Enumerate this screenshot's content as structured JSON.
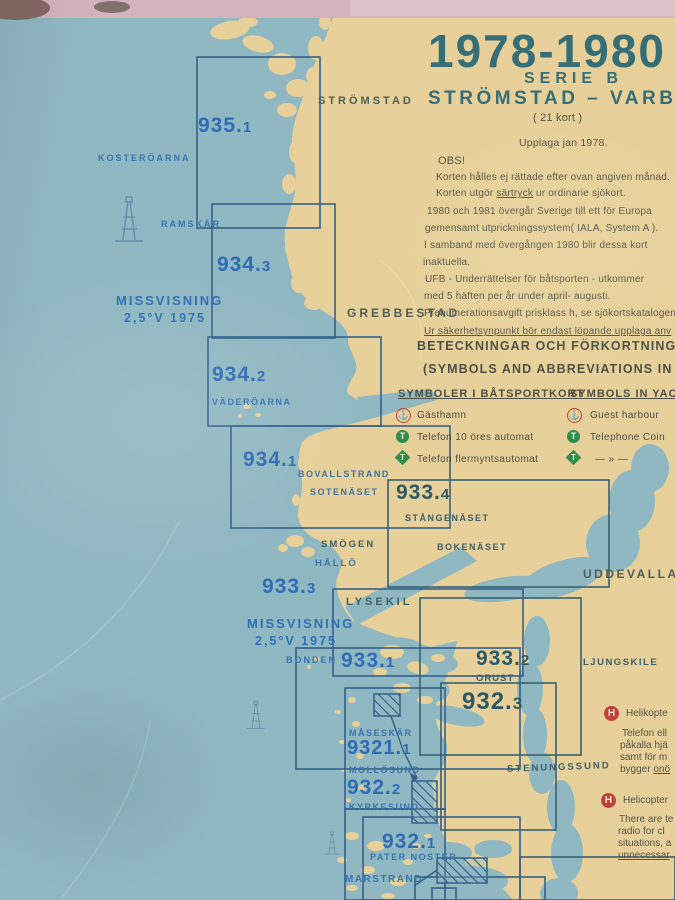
{
  "title": {
    "years": "1978-1980",
    "serie": "SERIE B",
    "route": "STRÖMSTAD – VARBER",
    "kort": "( 21 kort )",
    "upplaga": "Upplaga  jan  1978."
  },
  "notes": {
    "obs": "OBS!",
    "line1": "Korten hålles ej rättade efter ovan angiven månad.",
    "sartryck_pre": "Korten utgör ",
    "sartryck_word": "särtryck",
    "sartryck_post": " ur ordinarie sjökort.",
    "p2_l1": "1980 och 1981 övergår Sverige till ett för Europa",
    "p2_l2": "gemensamt utprickningssystem( IALA, System A ).",
    "p2_l3": "I samband med övergången 1980 blir dessa kort",
    "p2_l4": "inaktuella.",
    "ufb_l1": "UFB - Underrättelser för båtsporten - utkommer",
    "ufb_l2": "med 5 häften per år under april- augusti.",
    "ufb_l3": "Prenumerationsavgift prisklass h, se sjökortskatalogen.",
    "safety": "Ur säkerhetsynpunkt bör endast löpande upplaga anv",
    "beteckningar": "BETECKNINGAR OCH FÖRKORTNINGAR I KO",
    "symbols_en": "(SYMBOLS AND ABBREVIATIONS IN CHA"
  },
  "legend": {
    "header_sv": "SYMBOLER I BÅTSPORTKORT",
    "header_en": "SYMBOLS IN YAC",
    "row1_sv": "Gästhamn",
    "row1_en": "Guest harbour",
    "row2_sv": "Telefon 10 öres automat",
    "row2_en": "Telephone Coin",
    "row3_sv": "Telefon flermyntsautomat",
    "row3_en": "—  »  —"
  },
  "icons": {
    "anchor": "⚓",
    "phone_letter": "T",
    "heli_letter": "H"
  },
  "heli_sv": {
    "heading": "Helikopte",
    "l1": "Telefon ell",
    "l2": "påkalla hjä",
    "l3": "samt för m",
    "l4_pre": "bygger ",
    "l4_u": "onö"
  },
  "heli_en": {
    "heading": "Helicopter",
    "l1": "There are te",
    "l2": "radio for cl",
    "l3": "situations, a",
    "l4": "unnecessar"
  },
  "missvisning": {
    "l1": "MISSVISNING",
    "l2": "2,5°V  1975"
  },
  "charts": {
    "c935_1": {
      "main": "935.",
      "suffix": "1"
    },
    "c934_3": {
      "main": "934.",
      "suffix": "3"
    },
    "c934_2": {
      "main": "934.",
      "suffix": "2"
    },
    "c934_1": {
      "main": "934.",
      "suffix": "1"
    },
    "c933_4": {
      "main": "933.",
      "suffix": "4"
    },
    "c933_3": {
      "main": "933.",
      "suffix": "3"
    },
    "c933_1": {
      "main": "933.",
      "suffix": "1"
    },
    "c933_2": {
      "main": "933.",
      "suffix": "2"
    },
    "c932_3": {
      "main": "932.",
      "suffix": "3"
    },
    "c9321_1": {
      "main": "9321.",
      "suffix": "1"
    },
    "c932_2": {
      "main": "932.",
      "suffix": "2"
    },
    "c932_1": {
      "main": "932.",
      "suffix": "1"
    }
  },
  "places": {
    "stromstad": "STRÖMSTAD",
    "kosteroarna": "KOSTERÖARNA",
    "ramskar": "RAMSKÄR",
    "grebbestad": "GREBBESTAD",
    "vaderoarna": "VÄDERÖARNA",
    "bovallstrand": "BOVALLSTRAND",
    "sotenaset": "SOTENÄSET",
    "stangenaset": "STÅNGENÄSET",
    "bokenaset": "BOKENÄSET",
    "smogen": "SMÖGEN",
    "hallo": "HÅLLÖ",
    "lysekil": "LYSEKIL",
    "uddevalla": "UDDEVALLA",
    "bonden": "BONDEN",
    "orust": "ORUST",
    "ljungskile": "LJUNGSKILE",
    "stenungssund": "STENUNGSSUND",
    "maseskar": "MÅSESKÄR",
    "mollosund": "MOLLÖSUND",
    "kyrkesund": "KYRKESUND",
    "pater_noster": "PATER NOSTER",
    "marstrand": "MARSTRAND"
  },
  "colors": {
    "sea": "#90b8c2",
    "land": "#e7d099",
    "wall_pink": "#d4b3bd",
    "print_blue": "#2e6cb5",
    "print_teal": "#356e76",
    "print_red": "#c2403a",
    "print_green": "#2f8f4e"
  }
}
